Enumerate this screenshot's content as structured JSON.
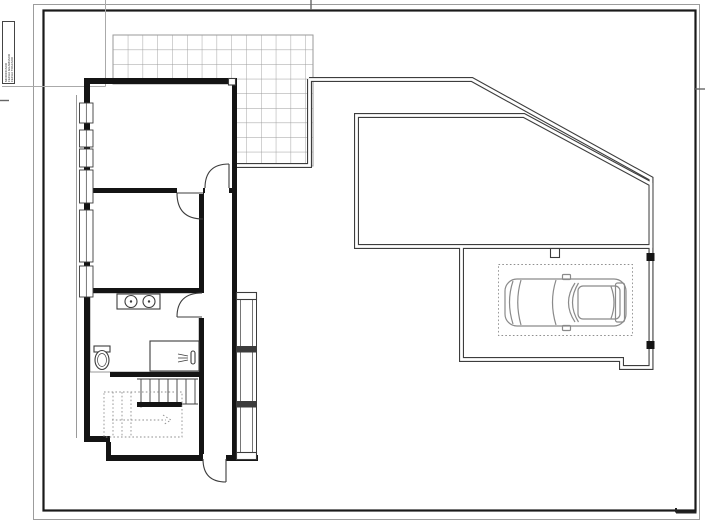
{
  "title_block": {
    "lines": [
      "MODIFICADO",
      "FECHA GUARDADO",
      "FECHA TRAZADO"
    ]
  },
  "plan": {
    "features": [
      "terrace-paving-grid",
      "house",
      "bedroom-upper",
      "bedroom-middle",
      "bathroom",
      "double-sink-vanity",
      "toilet",
      "shower",
      "staircase",
      "corridor",
      "glazed-gallery",
      "entry-door",
      "site-boundary-wall",
      "driveway-court",
      "garage",
      "parking-space",
      "car-top-view"
    ]
  },
  "colors": {
    "paper": "#ffffff",
    "frame": "#1a1a1a",
    "outer-border": "#9c9c9c",
    "wall": "#141414",
    "site-wall": "#3d3d3d",
    "detail": "#3c3c3c",
    "light": "#8f8f8f",
    "grid-large": "#9a9a9a",
    "grid-tile": "#c6c6c6",
    "dotted": "#8f8f8f",
    "car": "#8a8a8a",
    "fold-mark": "#666666",
    "reg-line": "#aaaaaa"
  }
}
